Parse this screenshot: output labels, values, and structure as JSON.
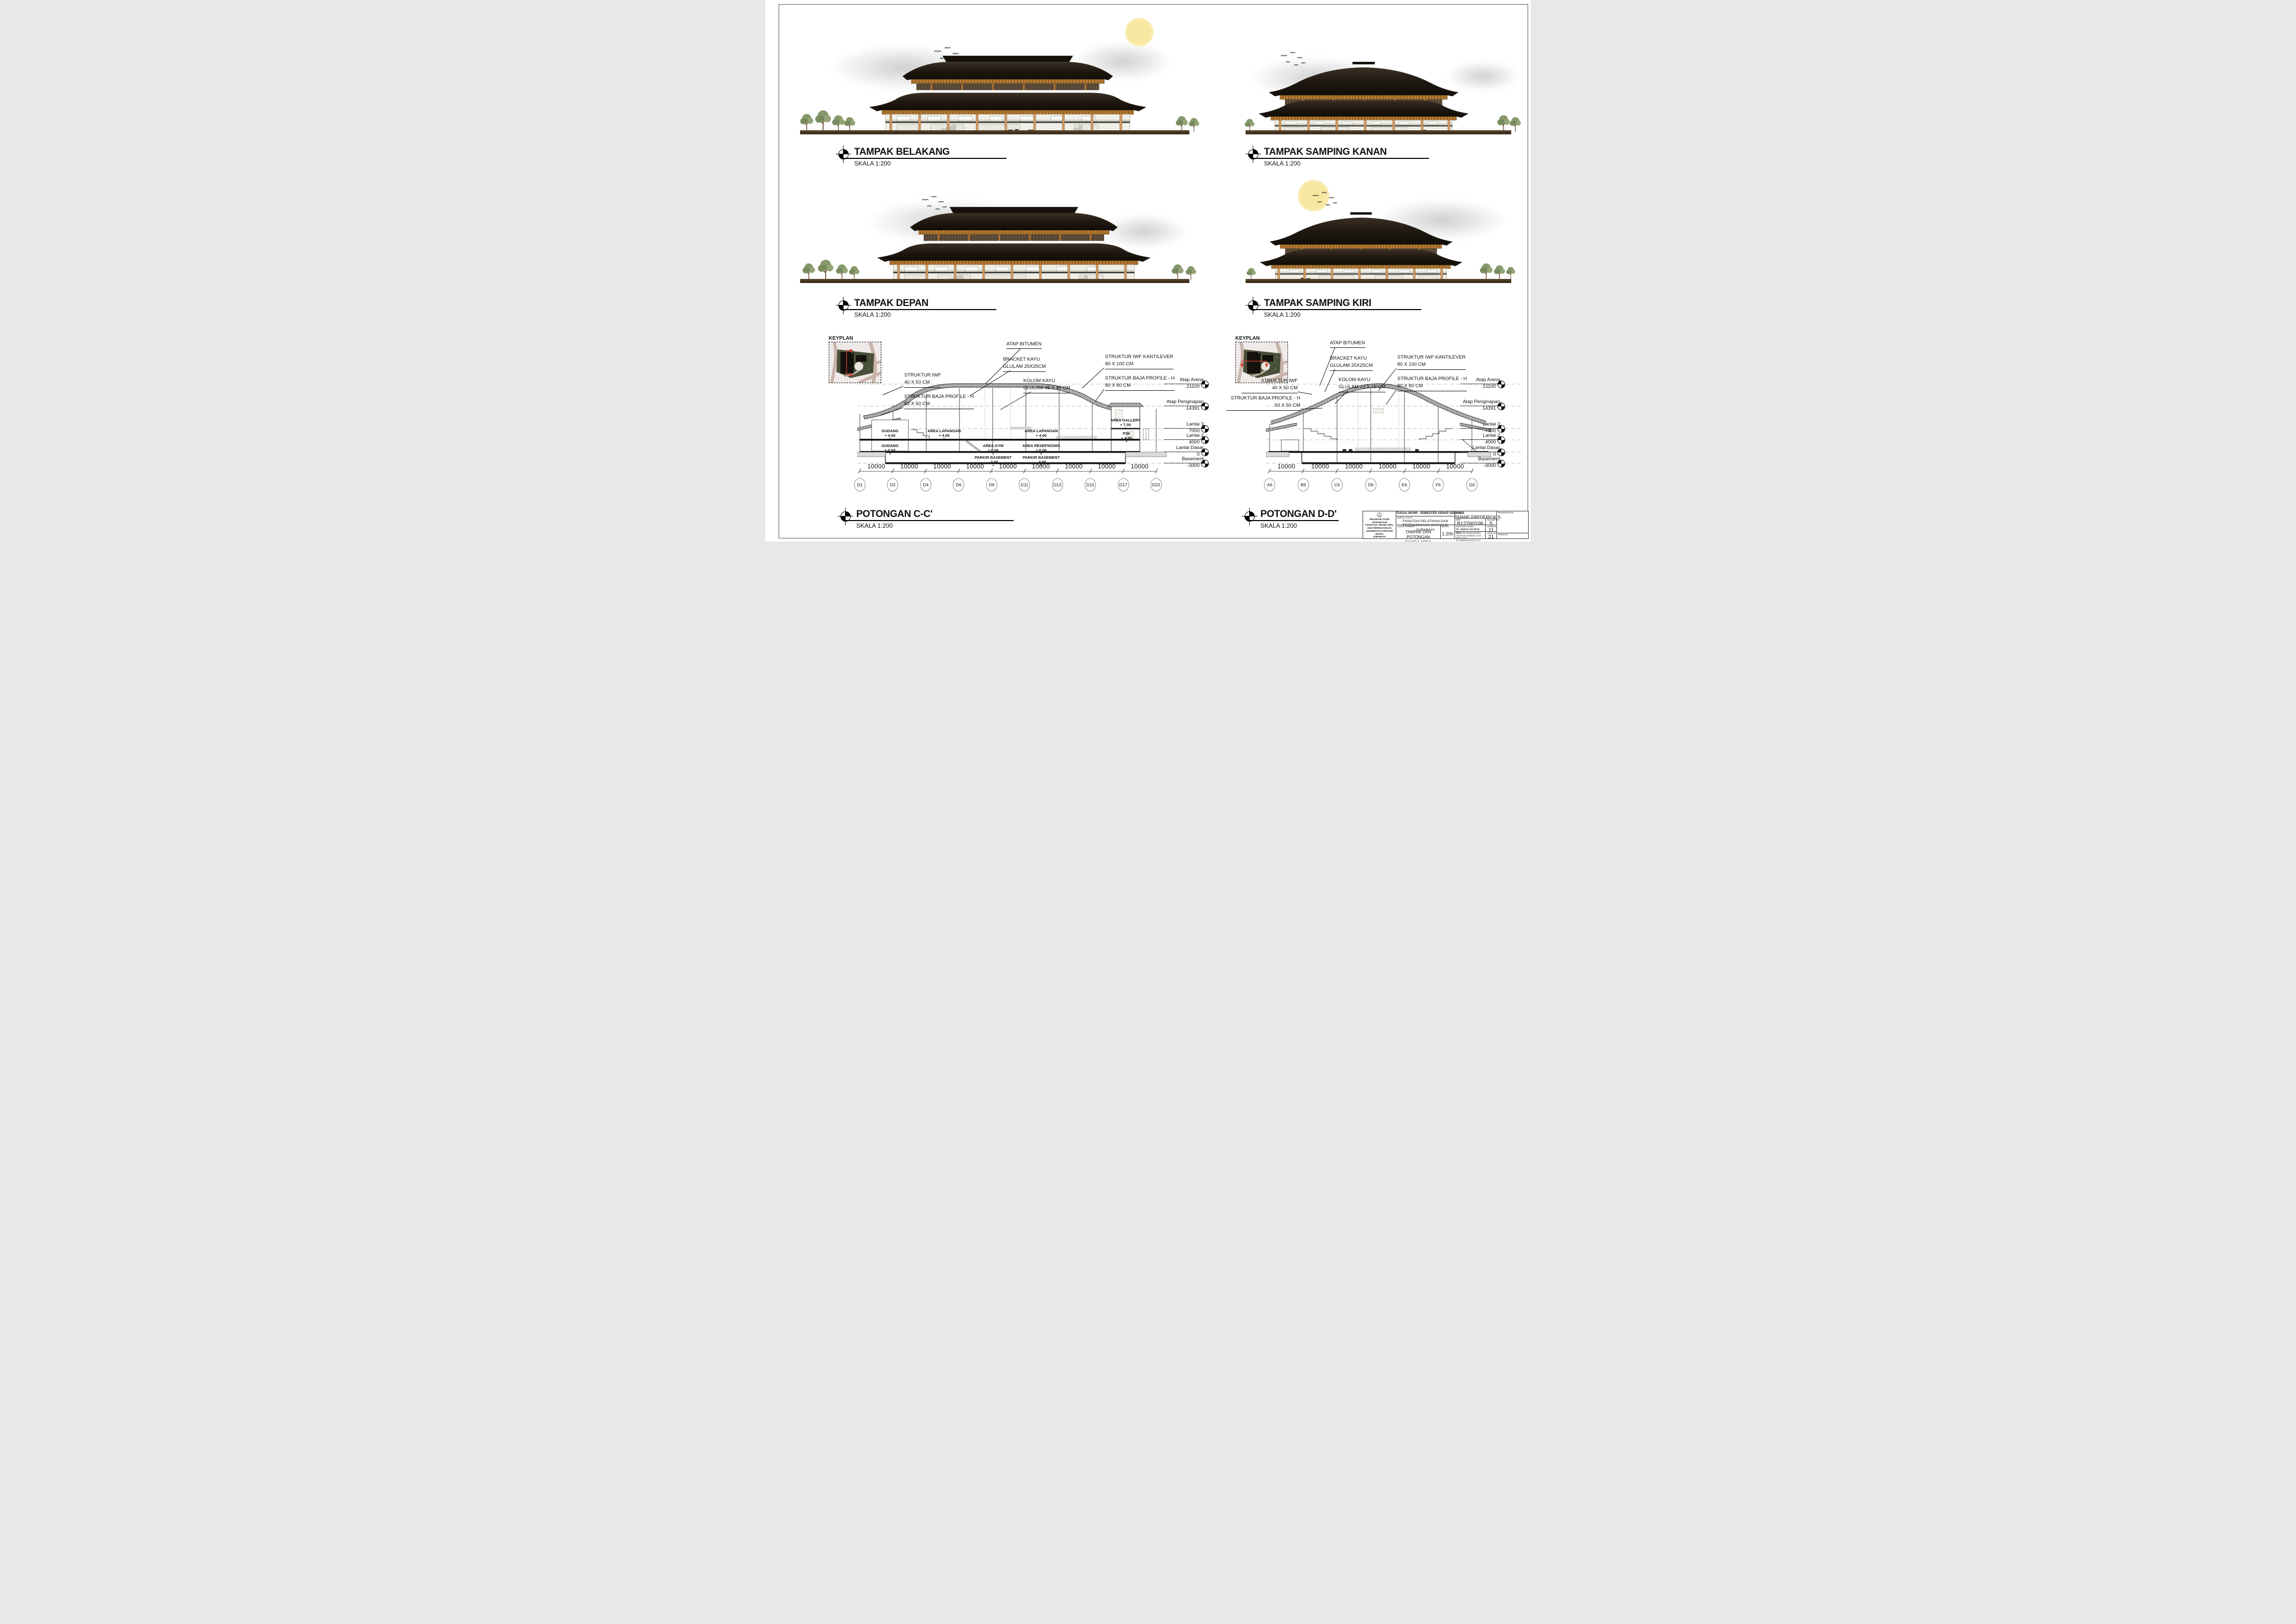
{
  "sheet": {
    "type_label": "Architectural elevation and section sheet"
  },
  "palette": {
    "roof_dark": "#1d1712",
    "bracket_wood": "#c08438",
    "column_wood": "#cf9a63",
    "wall": "#efeee6",
    "ground": "#46331f",
    "tree_green": "#87996b",
    "sun_yellow": "#f6e39e",
    "cloud_grey": "#d9d9d9",
    "section_line": "#1a1a1a",
    "keyplan_site": "#49503a",
    "keyplan_road": "#c9b3ab",
    "cut_line_red": "#e03b30"
  },
  "icons": {
    "title_marker": "quartered-circle-icon",
    "level_marker": "quartered-circle-icon",
    "keyplan_cut": "red-section-cut-line"
  },
  "elevations": [
    {
      "title": "TAMPAK BELAKANG",
      "scale": "SKALA 1:200"
    },
    {
      "title": "TAMPAK SAMPING KANAN",
      "scale": "SKALA 1:200"
    },
    {
      "title": "TAMPAK DEPAN",
      "scale": "SKALA 1:200"
    },
    {
      "title": "TAMPAK SAMPING KIRI",
      "scale": "SKALA 1:200"
    }
  ],
  "sections": [
    {
      "title": "POTONGAN C-C'",
      "scale": "SKALA 1:200",
      "keyplan": "KEYPLAN",
      "annotations": [
        {
          "text": "ATAP BITUMEN"
        },
        {
          "text": "BRACKET KAYU\nGLULAM 25X25CM"
        },
        {
          "text": "KOLOM KAYU\nGLULAM 45 X 45 CM"
        },
        {
          "text": "STRUKTUR IWF\n40 X 50 CM"
        },
        {
          "text": "STRUKTUR BAJA PROFILE - H\n50 X 50 CM"
        },
        {
          "text": "STRUKTUR IWF KANTILEVER\n80 X 100 CM"
        },
        {
          "text": "STRUKTUR BAJA PROFILE - H\n80 X 80 CM"
        }
      ],
      "levels": [
        {
          "name": "Atap Arena",
          "value": "21100"
        },
        {
          "name": "Atap Penginapan",
          "value": "14391"
        },
        {
          "name": "Lantai 3",
          "value": "7000"
        },
        {
          "name": "Lantai 2",
          "value": "4000"
        },
        {
          "name": "Lantai Dasar",
          "value": "0"
        },
        {
          "name": "Basement",
          "value": "-3000"
        }
      ],
      "rooms": [
        {
          "name": "GUDANG",
          "elev": "+ 4.00"
        },
        {
          "name": "AREA LAPANGAN",
          "elev": "+ 4.00"
        },
        {
          "name": "AREA LAPANGAN",
          "elev": "+ 4.00"
        },
        {
          "name": "AREA GALLERY",
          "elev": "+ 7.00"
        },
        {
          "name": "P3K",
          "elev": "+ 4.00"
        },
        {
          "name": "GUDANG",
          "elev": "± 0.00"
        },
        {
          "name": "AREA GYM",
          "elev": "± 0.00"
        },
        {
          "name": "AREA RESEPSIONIS",
          "elev": "± 0.00"
        },
        {
          "name": "PARKIR BASEMENT",
          "elev": "- 3.00"
        },
        {
          "name": "PARKIR BASEMENT",
          "elev": "- 3.00"
        }
      ],
      "dims": [
        "10000",
        "10000",
        "10000",
        "10000",
        "10000",
        "10000",
        "10000",
        "10000",
        "10000"
      ],
      "grids": [
        "D1",
        "D2",
        "D4",
        "D6",
        "D9",
        "D11",
        "D13",
        "D15",
        "D17",
        "D22"
      ]
    },
    {
      "title": "POTONGAN D-D'",
      "scale": "SKALA 1:200",
      "keyplan": "KEYPLAN",
      "annotations": [
        {
          "text": "ATAP BITUMEN"
        },
        {
          "text": "BRACKET KAYU\nGLULAM 25X25CM"
        },
        {
          "text": "KOLOM KAYU\nGLULAM 45 X 45 CM"
        },
        {
          "text": "STRUKTUR IWF\n40 X 50 CM"
        },
        {
          "text": "STRUKTUR BAJA PROFILE - H\n50 X 50 CM"
        },
        {
          "text": "STRUKTUR IWF KANTILEVER\n80 X 100 CM"
        },
        {
          "text": "STRUKTUR BAJA PROFILE - H\n80 X 80 CM"
        }
      ],
      "levels": [
        {
          "name": "Atap Arena",
          "value": "21100"
        },
        {
          "name": "Atap Penginapan",
          "value": "14391"
        },
        {
          "name": "Lantai 3",
          "value": "7000"
        },
        {
          "name": "Lantai 2",
          "value": "4000"
        },
        {
          "name": "Lantai Dasar",
          "value": "0"
        },
        {
          "name": "Basement",
          "value": "-3000"
        }
      ],
      "dims": [
        "10000",
        "10000",
        "10000",
        "10000",
        "10000",
        "10000"
      ],
      "grids": [
        "A6",
        "B6",
        "C6",
        "D6",
        "E6",
        "F6",
        "G6"
      ]
    }
  ],
  "titleblock": {
    "header": "TUGAS AKHIR - SEMESTER GENAP 2023/2024",
    "nama_label": "NAMA",
    "nama": "SHANE FREDERICK S.",
    "pengesahan_label": "PENGESAHAN",
    "judul_tugas_label": "JUDUL TUGAS",
    "judul_tugas": "FASILITAS PELATIHAN DAN\nPERTANDINGAN WUSHU DI SURABAYA",
    "nrp_label": "NRP",
    "nrp": "B12200106",
    "kelompok_label": "KELOMPOK",
    "kelompok": "5",
    "judul_gambar_label": "JUDUL GAMBAR",
    "judul_gambar": "TAMPAK DAN POTONGAN\nMASSA AREA LAPANGAN",
    "skala_label": "SKALA",
    "skala": "1:200",
    "mentor_utama_label": "MENTOR UTAMA",
    "mentor_utama": "IR. ANDHI WIJAYA, M.T.",
    "lembar_label": "LEMBAR",
    "lembar": "11",
    "mentor_pendamping_label": "MENTOR PENDAMPING",
    "mentor_pendamping": "TIMOTICIN KWANDA, B.SC., MRP., PH.D.\nIR. IRWAN SANTOSO, M.T.\nBRAM MICHAEL WAYNE, S.T., M.ARS.",
    "jumlah_label": "JUMLAH",
    "jumlah": "21",
    "tanggal_label": "TANGGAL",
    "institution": "PROGRAM STUDI ARSITEKTUR\nFAKULTAS TEKNIK SIPIL DAN PERENCANAAN\nUNIVERSITAS KRISTEN PETRA\nSURABAYA",
    "logo": "UNIVERSITAS KRISTEN PETRA"
  }
}
